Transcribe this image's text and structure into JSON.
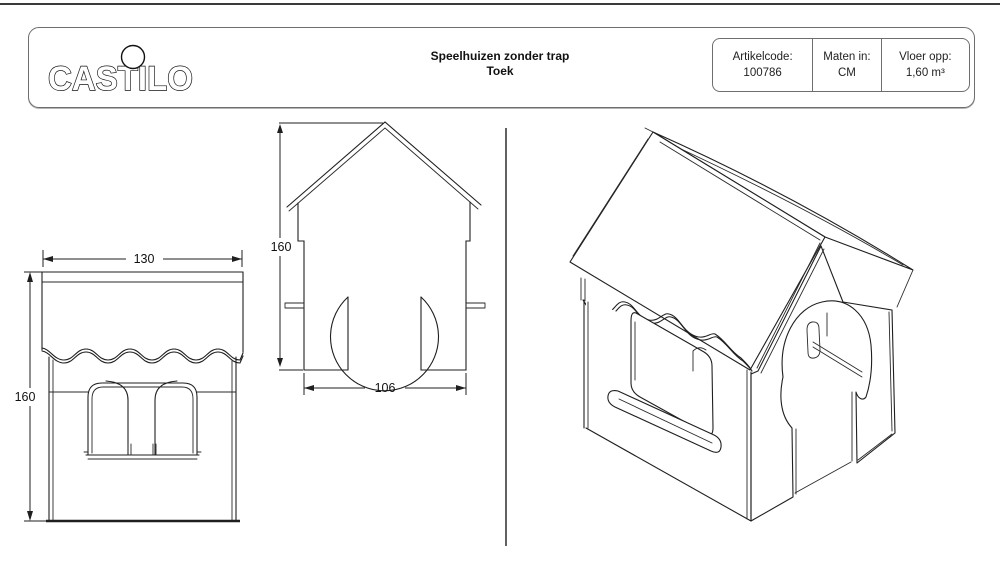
{
  "sheet": {
    "logo_text": "CASTILO",
    "title_line1": "Speelhuizen zonder trap",
    "title_line2": "Toek",
    "info": {
      "artikelcode_label": "Artikelcode:",
      "artikelcode_value": "100786",
      "maten_label": "Maten in:",
      "maten_value": "CM",
      "vloer_label": "Vloer opp:",
      "vloer_value": "1,60 m³"
    }
  },
  "views": {
    "side_view": {
      "width_dim": "130",
      "height_dim": "160"
    },
    "front_view": {
      "height_dim": "160",
      "width_dim": "106"
    }
  },
  "colors": {
    "line": "#1f1f1f",
    "frame_gray": "#6e6e6e",
    "background": "#ffffff"
  }
}
